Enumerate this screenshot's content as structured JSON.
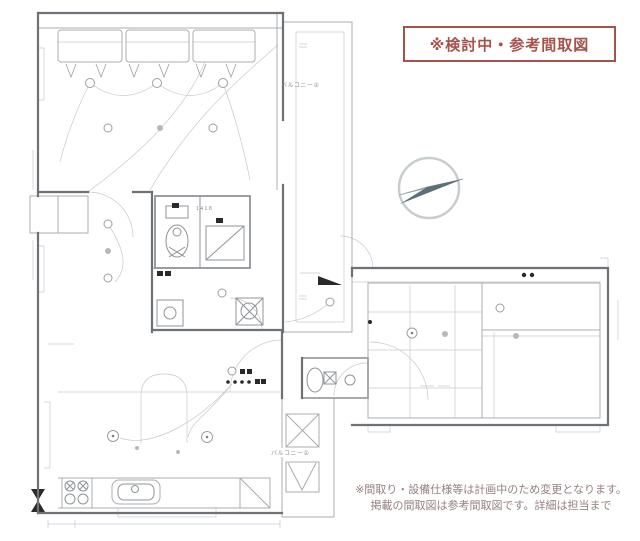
{
  "notice_box": {
    "label": "※検討中・参考間取図",
    "border_color": "#a5524b",
    "text_color": "#a5524b"
  },
  "floorplan": {
    "balcony_upper_label": "バルコニー②",
    "balcony_lower_label": "バルコニー①",
    "bath_dimension": "1418",
    "line_color": "#9aa0a6",
    "wall_color": "#6e7276"
  },
  "compass": {
    "style": "north-arrow",
    "dark_color": "#5d7078"
  },
  "disclaimer": {
    "line1": "※間取り・設備仕様等は計画中のため変更となります。",
    "line2": "掲載の間取図は参考間取図です。詳細は担当まで",
    "text_color": "#95807f"
  }
}
